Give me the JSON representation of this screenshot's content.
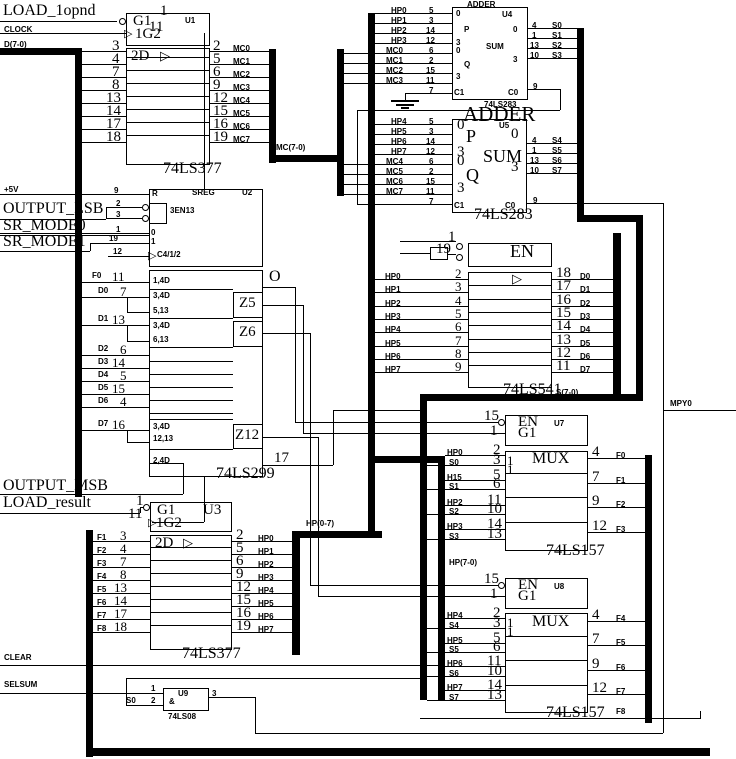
{
  "canvas": {
    "bg": "#ffffff",
    "ink": "#000000"
  },
  "signals": {
    "load_1opnd": "LOAD_1opnd",
    "clock": "CLOCK",
    "d_bus": "D(7-0)",
    "p5v": "+5V",
    "output_lsb": "OUTPUT_LSB",
    "sr_mode0": "SR_MODE0",
    "sr_mode1": "SR_MODE1",
    "output_msb": "OUTPUT_MSB",
    "load_result": "LOAD_result",
    "clear": "CLEAR",
    "selsum": "SELSUM",
    "mpy0": "MPY0"
  },
  "bus_labels": {
    "mc": "MC(7-0)",
    "hp_out": "HP(0-7)",
    "hp_mux": "HP(7-0)",
    "s": "S(7-0)",
    "f8": "F8"
  },
  "u1": {
    "ref": "U1",
    "part": "74LS377",
    "g1": "G1",
    "g2": "1G2",
    "sec": "2D",
    "tri": "▷",
    "pin_g1": "1",
    "pin_g2": "11",
    "in_pins": [
      "3",
      "4",
      "7",
      "8",
      "13",
      "14",
      "17",
      "18"
    ],
    "out_pins": [
      "2",
      "5",
      "6",
      "9",
      "12",
      "15",
      "16",
      "19"
    ],
    "out_nets": [
      "MC0",
      "MC1",
      "MC2",
      "MC3",
      "MC4",
      "MC5",
      "MC6",
      "MC7"
    ]
  },
  "u2": {
    "ref": "U2",
    "part": "74LS299",
    "title": "SREG",
    "r": "R",
    "r_pin": "9",
    "en_label": "3EN13",
    "en_pins": [
      "2",
      "3"
    ],
    "mode_marks": [
      "0",
      "1"
    ],
    "mode_pins": [
      "1",
      "19"
    ],
    "clk_label": "C4/1/2",
    "clk_pin": "12",
    "tri": "▷",
    "o": "O",
    "fn": [
      "1,4D",
      "3,4D",
      "5,13",
      "3,4D",
      "6,13",
      "3,4D",
      "12,13",
      "2,4D"
    ],
    "z": [
      "Z5",
      "Z6",
      "Z12"
    ],
    "in_nets": [
      "F0",
      "D0",
      "D1",
      "D2",
      "D3",
      "D4",
      "D5",
      "D6",
      "D7"
    ],
    "in_pins": [
      "11",
      "7",
      "13",
      "6",
      "14",
      "5",
      "15",
      "4",
      "16"
    ],
    "out_pin": "17"
  },
  "u4": {
    "ref": "U4",
    "part": "74LS283",
    "title": "ADDER",
    "p": "P",
    "q": "Q",
    "sum": "SUM",
    "c1": "C1",
    "c0": "C0",
    "c1_pin": "7",
    "c0_pin": "9",
    "marks": [
      "0",
      "3"
    ],
    "in_nets": [
      "HP0",
      "HP1",
      "HP2",
      "HP3",
      "MC0",
      "MC1",
      "MC2",
      "MC3"
    ],
    "in_pins": [
      "5",
      "3",
      "14",
      "12",
      "6",
      "2",
      "15",
      "11"
    ],
    "out_pins": [
      "4",
      "1",
      "13",
      "10"
    ],
    "out_nets": [
      "S0",
      "S1",
      "S2",
      "S3"
    ]
  },
  "u5": {
    "ref": "U5",
    "part": "74LS283",
    "title": "ADDER",
    "p": "P",
    "q": "Q",
    "sum": "SUM",
    "c1": "C1",
    "c0": "C0",
    "c1_pin": "7",
    "c0_pin": "9",
    "marks": [
      "0",
      "3"
    ],
    "in_nets": [
      "HP4",
      "HP5",
      "HP6",
      "HP7",
      "MC4",
      "MC5",
      "MC6",
      "MC7"
    ],
    "in_pins": [
      "5",
      "3",
      "14",
      "12",
      "6",
      "2",
      "15",
      "11"
    ],
    "out_pins": [
      "4",
      "1",
      "13",
      "10"
    ],
    "out_nets": [
      "S4",
      "S5",
      "S6",
      "S7"
    ]
  },
  "u541": {
    "part": "74LS541",
    "en": "EN",
    "tri": "▷",
    "en_pins": [
      "1",
      "19"
    ],
    "in_nets": [
      "HP0",
      "HP1",
      "HP2",
      "HP3",
      "HP4",
      "HP5",
      "HP6",
      "HP7"
    ],
    "in_pins": [
      "2",
      "3",
      "4",
      "5",
      "6",
      "7",
      "8",
      "9"
    ],
    "out_pins": [
      "18",
      "17",
      "16",
      "15",
      "14",
      "13",
      "12",
      "11"
    ],
    "out_nets": [
      "D0",
      "D1",
      "D2",
      "D3",
      "D4",
      "D5",
      "D6",
      "D7"
    ]
  },
  "u3": {
    "ref": "U3",
    "part": "74LS377",
    "g1": "G1",
    "g2": "1G2",
    "sec": "2D",
    "tri": "▷",
    "pin_g1": "1",
    "pin_g2": "11",
    "in_nets": [
      "F1",
      "F2",
      "F3",
      "F4",
      "F5",
      "F6",
      "F7",
      "F8"
    ],
    "in_pins": [
      "3",
      "4",
      "7",
      "8",
      "13",
      "14",
      "17",
      "18"
    ],
    "out_pins": [
      "2",
      "5",
      "6",
      "9",
      "12",
      "15",
      "16",
      "19"
    ],
    "out_nets": [
      "HP0",
      "HP1",
      "HP2",
      "HP3",
      "HP4",
      "HP5",
      "HP6",
      "HP7"
    ]
  },
  "u7": {
    "ref": "U7",
    "part": "74LS157",
    "en": "EN",
    "g1": "G1",
    "title": "MUX",
    "mark": "1",
    "en_pin": "15",
    "g1_pin": "1",
    "in_nets": [
      "HP0",
      "S0",
      "H15",
      "S1",
      "HP2",
      "S2",
      "HP3",
      "S3"
    ],
    "in_pins": [
      "2",
      "3",
      "5",
      "6",
      "11",
      "10",
      "14",
      "13"
    ],
    "out_pins": [
      "4",
      "7",
      "9",
      "12"
    ],
    "out_nets": [
      "F0",
      "F1",
      "F2",
      "F3"
    ]
  },
  "u8": {
    "ref": "U8",
    "part": "74LS157",
    "en": "EN",
    "g1": "G1",
    "title": "MUX",
    "mark": "1",
    "en_pin": "15",
    "g1_pin": "1",
    "in_nets": [
      "HP4",
      "S4",
      "HP5",
      "S5",
      "HP6",
      "S6",
      "HP7",
      "S7"
    ],
    "in_pins": [
      "2",
      "3",
      "5",
      "6",
      "11",
      "10",
      "14",
      "13"
    ],
    "out_pins": [
      "4",
      "7",
      "9",
      "12"
    ],
    "out_nets": [
      "F4",
      "F5",
      "F6",
      "F7"
    ]
  },
  "u9": {
    "ref": "U9",
    "part": "74LS08",
    "gate": "&",
    "pin1": "1",
    "pin2": "2",
    "pin3": "3",
    "in_net": "S0"
  }
}
